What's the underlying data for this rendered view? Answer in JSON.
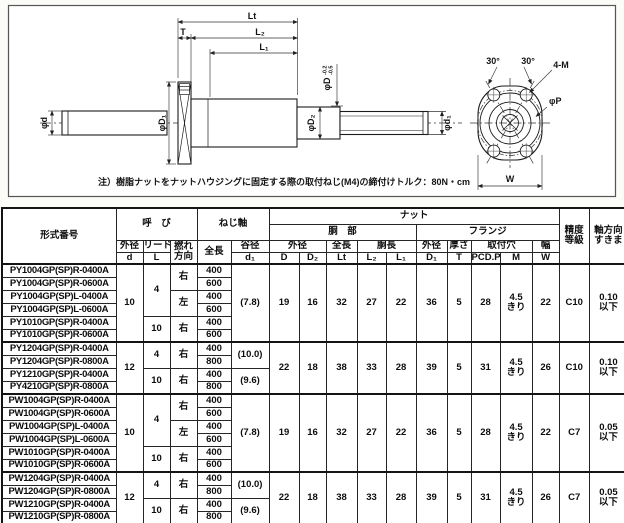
{
  "drawing": {
    "note": "注）樹脂ナットをナットハウジングに固定する際の取付ねじ(M4)の締付けトルク：80N・cm",
    "labels": {
      "Lt": "Lt",
      "T": "T",
      "L2": "L₂",
      "L1": "L₁",
      "phi_d": "φd",
      "phi_D1": "φD₁",
      "phi_D2": "φD₂",
      "phi_d1": "φd₁",
      "phi_D": "φD",
      "tol_upper": "-0.2",
      "tol_lower": "-0.5",
      "angle_left": "30°",
      "angle_right": "30°",
      "mount_holes": "4-M",
      "phi_P": "φP",
      "W": "W"
    }
  },
  "table": {
    "headers": {
      "model": "形式番号",
      "nominal": "呼　び",
      "screw_shaft": "ねじ軸",
      "nut": "ナット",
      "nut_body": "胴　部",
      "flange": "フランジ",
      "od": "外径",
      "lead": "リード",
      "twist_1": "撚れ",
      "twist_2": "方向",
      "length": "全長",
      "root": "谷径",
      "body_len": "胴長",
      "thickness": "厚さ",
      "holes": "取付穴",
      "width": "幅",
      "sym_d": "d",
      "sym_L": "L",
      "sym_d1": "d₁",
      "sym_D": "D",
      "sym_D2": "D₂",
      "sym_Lt": "Lt",
      "sym_L2": "L₂",
      "sym_L1": "L₁",
      "sym_D1": "D₁",
      "sym_T": "T",
      "sym_P": "PCD.P",
      "sym_M": "M",
      "sym_W": "W",
      "grade_1": "精度",
      "grade_2": "等級",
      "play_1": "軸方向",
      "play_2": "すきま"
    },
    "g1": {
      "od": "10",
      "lead_top": "4",
      "lead_bottom": "10",
      "dir_top": "右",
      "dir_mid": "左",
      "dir_bottom": "右",
      "models": [
        "PY1004GP(SP)R-0400A",
        "PY1004GP(SP)R-0600A",
        "PY1004GP(SP)L-0400A",
        "PY1004GP(SP)L-0600A",
        "PY1010GP(SP)R-0400A",
        "PY1010GP(SP)R-0600A"
      ],
      "lengths": [
        "400",
        "600",
        "400",
        "600",
        "400",
        "600"
      ],
      "root": "(7.8)",
      "D": "19",
      "D2": "16",
      "Lt": "32",
      "L2": "27",
      "L1": "22",
      "D1": "36",
      "T": "5",
      "P": "28",
      "M_1": "4.5",
      "M_2": "きり",
      "W": "22",
      "grade": "C10",
      "play_1": "0.10",
      "play_2": "以下"
    },
    "g2": {
      "od": "12",
      "lead_top": "4",
      "lead_bottom": "10",
      "dir_top": "右",
      "dir_bottom": "右",
      "models": [
        "PY1204GP(SP)R-0400A",
        "PY1204GP(SP)R-0800A",
        "PY1210GP(SP)R-0400A",
        "PY4210GP(SP)R-0800A"
      ],
      "lengths": [
        "400",
        "800",
        "400",
        "800"
      ],
      "root_top": "(10.0)",
      "root_bottom": "(9.6)",
      "D": "22",
      "D2": "18",
      "Lt": "38",
      "L2": "33",
      "L1": "28",
      "D1": "39",
      "T": "5",
      "P": "31",
      "M_1": "4.5",
      "M_2": "きり",
      "W": "26",
      "grade": "C10",
      "play_1": "0.10",
      "play_2": "以下"
    },
    "g3": {
      "od": "10",
      "lead_top": "4",
      "lead_bottom": "10",
      "dir_top": "右",
      "dir_mid": "左",
      "dir_bottom": "右",
      "models": [
        "PW1004GP(SP)R-0400A",
        "PW1004GP(SP)R-0600A",
        "PW1004GP(SP)L-0400A",
        "PW1004GP(SP)L-0600A",
        "PW1010GP(SP)R-0400A",
        "PW1010GP(SP)R-0600A"
      ],
      "lengths": [
        "400",
        "600",
        "400",
        "600",
        "400",
        "600"
      ],
      "root": "(7.8)",
      "D": "19",
      "D2": "16",
      "Lt": "32",
      "L2": "27",
      "L1": "22",
      "D1": "36",
      "T": "5",
      "P": "28",
      "M_1": "4.5",
      "M_2": "きり",
      "W": "22",
      "grade": "C7",
      "play_1": "0.05",
      "play_2": "以下"
    },
    "g4": {
      "od": "12",
      "lead_top": "4",
      "lead_bottom": "10",
      "dir_top": "右",
      "dir_bottom": "右",
      "models": [
        "PW1204GP(SP)R-0400A",
        "PW1204GP(SP)R-0800A",
        "PW1210GP(SP)R-0400A",
        "PW1210GP(SP)R-0800A"
      ],
      "lengths": [
        "400",
        "800",
        "400",
        "800"
      ],
      "root_top": "(10.0)",
      "root_bottom": "(9.6)",
      "D": "22",
      "D2": "18",
      "Lt": "38",
      "L2": "33",
      "L1": "28",
      "D1": "39",
      "T": "5",
      "P": "31",
      "M_1": "4.5",
      "M_2": "きり",
      "W": "26",
      "grade": "C7",
      "play_1": "0.05",
      "play_2": "以下"
    }
  }
}
